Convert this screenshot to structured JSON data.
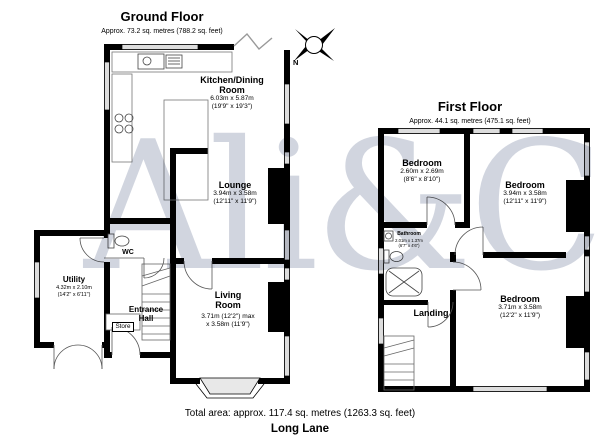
{
  "watermark": {
    "text": "Ali&Co"
  },
  "compass": {
    "label": "N"
  },
  "ground_floor": {
    "title": "Ground Floor",
    "subtitle": "Approx. 73.2 sq. metres (788.2 sq. feet)",
    "rooms": {
      "kitchen": {
        "name": "Kitchen/Dining Room",
        "dims_metric": "6.03m x 5.87m",
        "dims_imperial": "(19'9\" x 19'3\")"
      },
      "lounge": {
        "name": "Lounge",
        "dims_metric": "3.94m x 3.58m",
        "dims_imperial": "(12'11\" x 11'9\")"
      },
      "living_room": {
        "name": "Living Room",
        "dims_metric": "3.71m (12'2\") max",
        "dims_imperial": "x 3.58m (11'9\")"
      },
      "utility": {
        "name": "Utility",
        "dims_metric": "4.32m x 2.10m",
        "dims_imperial": "(14'2\" x 6'11\")"
      },
      "wc": {
        "name": "WC"
      },
      "store": {
        "name": "Store"
      },
      "entrance_hall": {
        "name": "Entrance Hall"
      }
    }
  },
  "first_floor": {
    "title": "First Floor",
    "subtitle": "Approx. 44.1 sq. metres (475.1 sq. feet)",
    "rooms": {
      "bedroom_1": {
        "name": "Bedroom",
        "dims_metric": "2.60m x 2.69m",
        "dims_imperial": "(8'6\" x 8'10\")"
      },
      "bedroom_2": {
        "name": "Bedroom",
        "dims_metric": "3.94m x 3.58m",
        "dims_imperial": "(12'11\" x 11'9\")"
      },
      "bedroom_3": {
        "name": "Bedroom",
        "dims_metric": "3.71m x 3.58m",
        "dims_imperial": "(12'2\" x 11'9\")"
      },
      "bathroom": {
        "name": "Bathroom",
        "dims_metric": "2.01m x 1.37m",
        "dims_imperial": "(6'7\" x 4'6\")"
      },
      "landing": {
        "name": "Landing"
      }
    }
  },
  "footer": {
    "total_area": "Total area: approx. 117.4 sq. metres (1263.3 sq. feet)",
    "address": "Long Lane"
  }
}
